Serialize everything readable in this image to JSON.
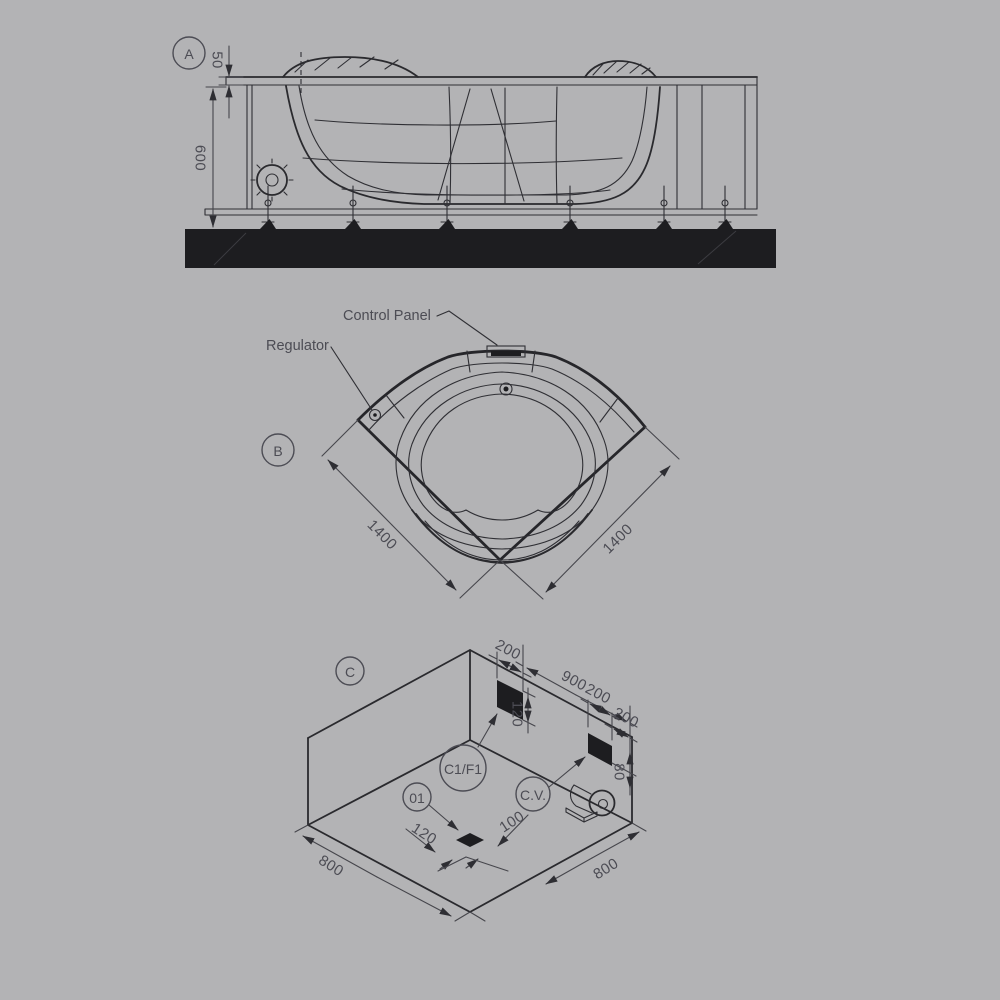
{
  "colors": {
    "background": "#b3b3b5",
    "line": "#2a2a2e",
    "dimension": "#46464c",
    "text": "#4c4c54",
    "solid_fill": "#1d1d20"
  },
  "view_a": {
    "label": "A",
    "dim_rim_offset": "50",
    "dim_height": "600"
  },
  "view_b": {
    "label": "B",
    "control_panel": "Control Panel",
    "regulator": "Regulator",
    "dim_side_left": "1400",
    "dim_side_right": "1400"
  },
  "view_c": {
    "label": "C",
    "callout_panel": "C1/F1",
    "callout_valve": "C.V.",
    "callout_drain": "01",
    "dim_panel_width": "200",
    "dim_wall": "900",
    "dim_valve_offset": "200",
    "dim_valve_width": "200",
    "dim_panel_height": "120",
    "dim_valve_height": "80",
    "dim_drain_a": "120",
    "dim_drain_b": "100",
    "dim_floor_left": "800",
    "dim_floor_right": "800"
  }
}
